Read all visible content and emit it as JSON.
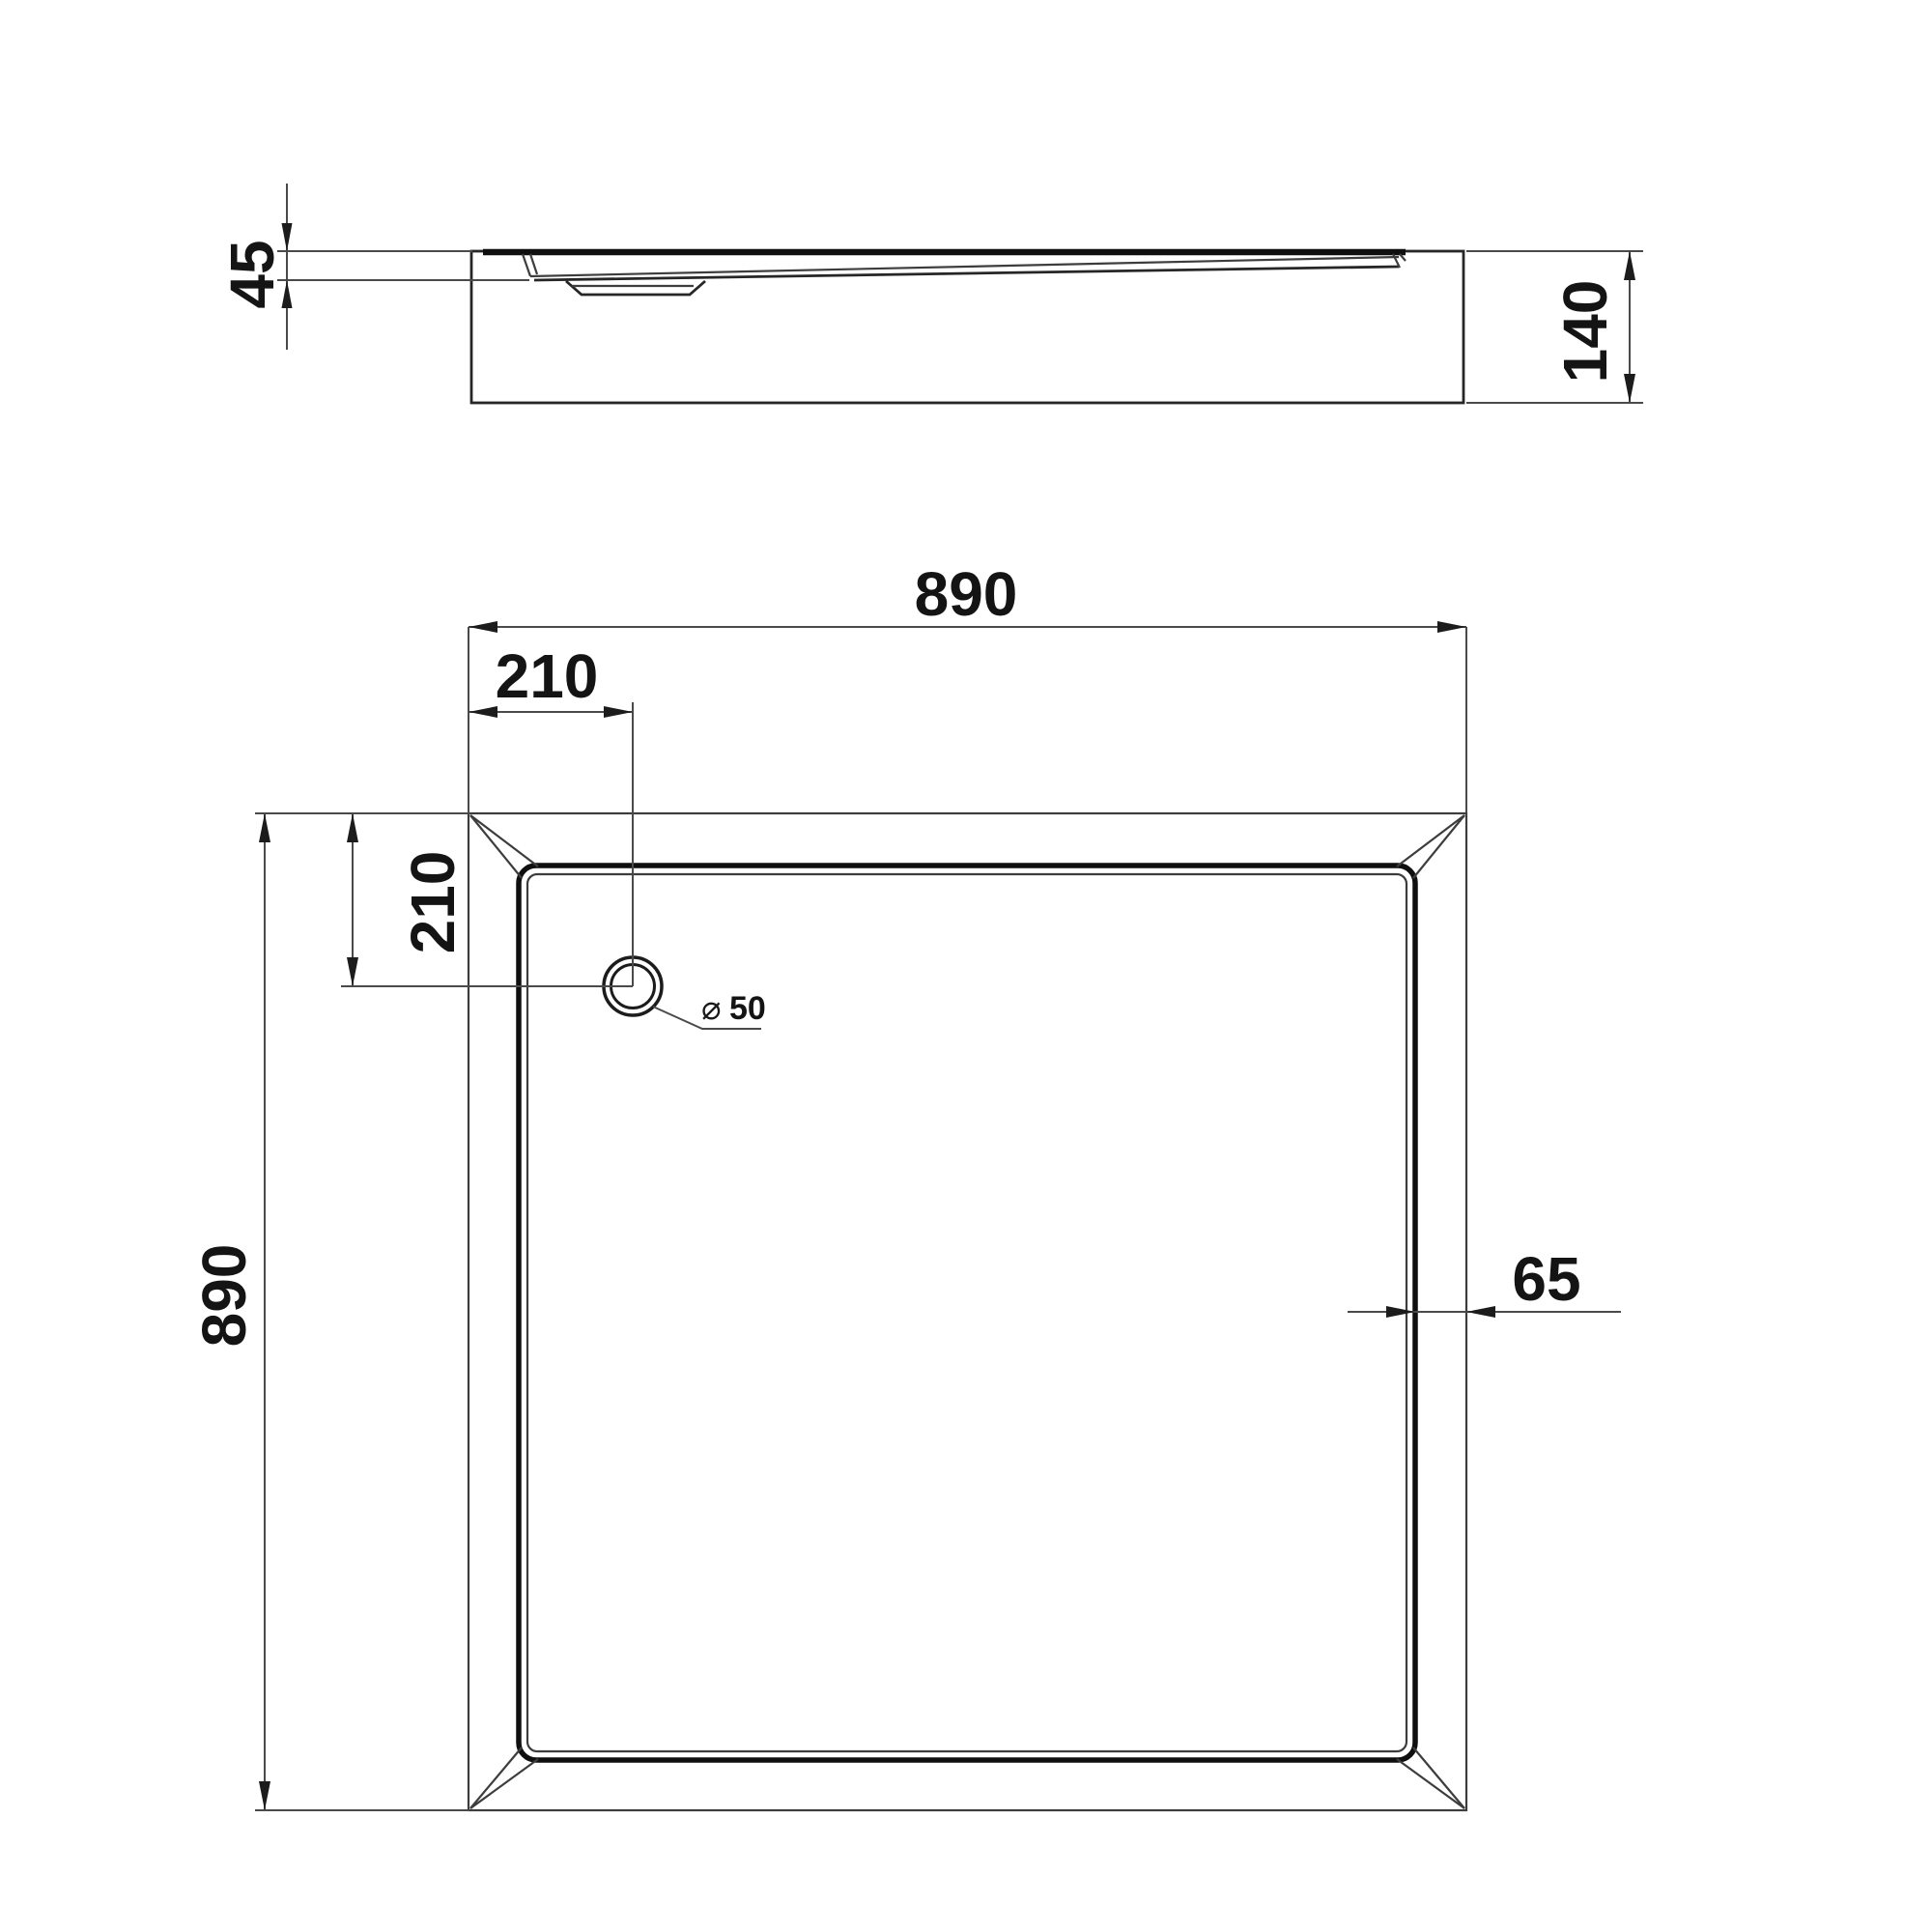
{
  "drawing": {
    "type": "shower-tray technical dimension drawing",
    "side_view": {
      "depth_label": "45",
      "height_label": "140"
    },
    "plan_view": {
      "width_label": "890",
      "height_label": "890",
      "drain_offset_top_label": "210",
      "drain_offset_left_label": "210",
      "rim_width_label": "65",
      "drain_diameter_symbol": "⌀",
      "drain_diameter_value": "50"
    },
    "colors": {
      "background": "#ffffff",
      "thin_line": "#3d3d3d",
      "heavy_line": "#0f0f0f",
      "dimension_line": "#4a4a4a",
      "text": "#141414"
    }
  }
}
